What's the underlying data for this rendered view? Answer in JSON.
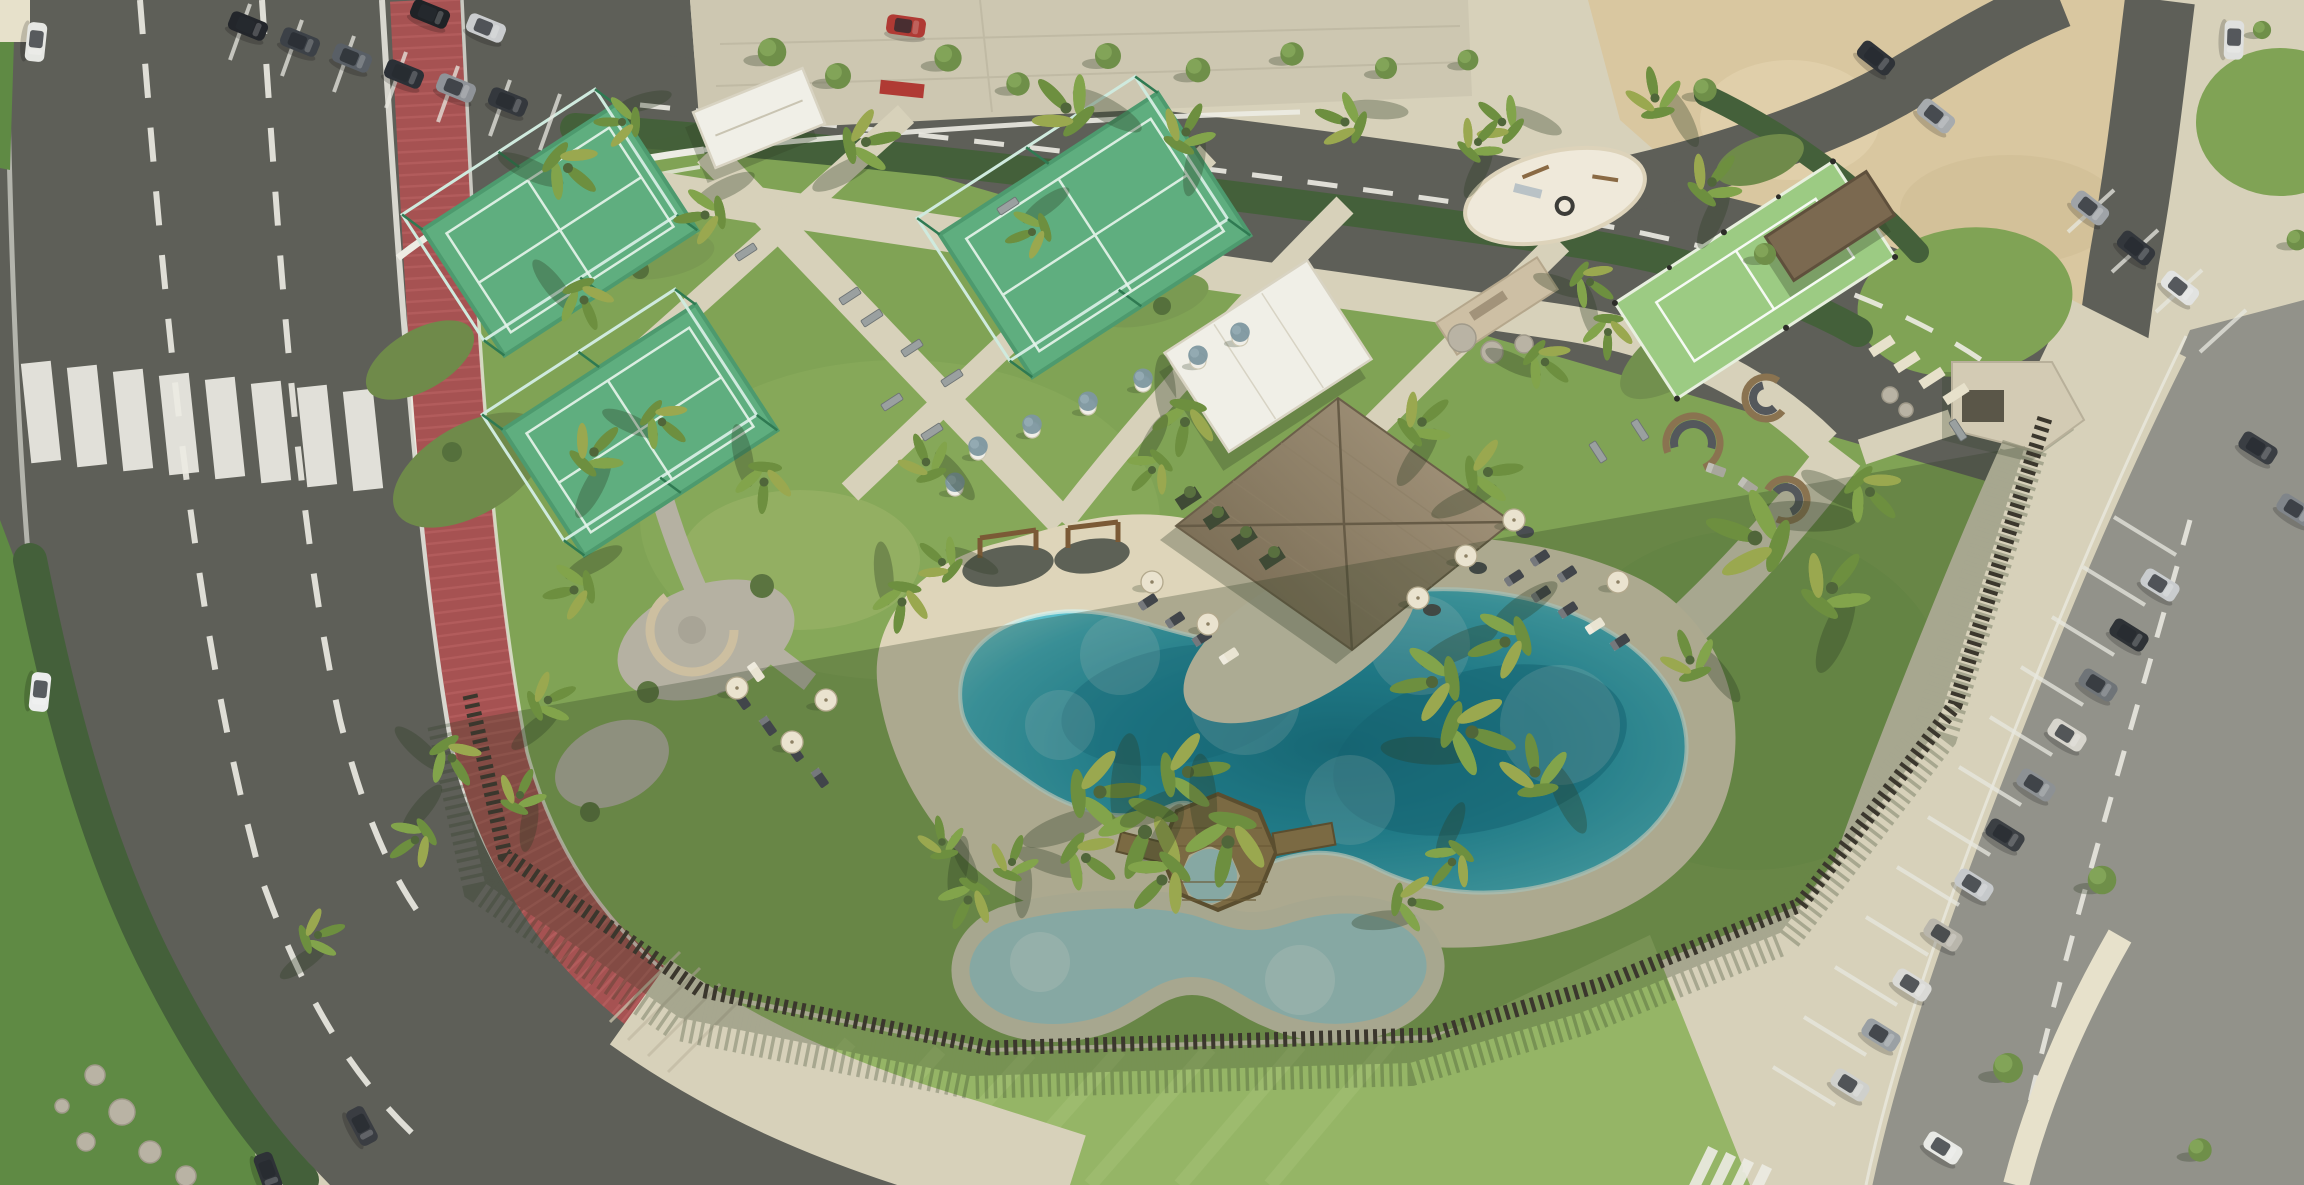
{
  "meta": {
    "title": "aerial-render-resort-amenity-park",
    "description": "Photorealistic aerial rendering of a resort amenity park with lagoon pool, padel courts, clubhouse, parking and roads. No visible text in image."
  },
  "palette": {
    "asphalt": "#5e5f58",
    "asphaltLight": "#6c6d65",
    "parking": "#92928a",
    "pavement": "#d7d1ba",
    "pavementLight": "#e7e1cb",
    "plaza": "#cdc7b1",
    "sandLot": "#d9c7a0",
    "sand": "#ded5ba",
    "lawn": "#80a355",
    "lawnLight": "#95b566",
    "lawnDark": "#5f8a44",
    "hedge": "#44603a",
    "bikePath": "#a65252",
    "bikePathLight": "#bb6565",
    "white": "#edece4",
    "court": "#5fae7f",
    "courtLight": "#79c295",
    "courtLine": "#e8f5ec",
    "courtFrame": "#2f7a52",
    "glass": "#cfeade",
    "sport": "#9ccb83",
    "waterLight": "#63c4cf",
    "water": "#2ba4bd",
    "waterDeep": "#0d7390",
    "kidsWater": "#a9d3d6",
    "wood": "#9a7c50",
    "woodDark": "#6e5634",
    "thatch": "#a2937a",
    "thatchDark": "#7b6e56",
    "whiteBld": "#f0efe7",
    "fence": "#3b372d",
    "gravel": "#b5b1a2",
    "stone": "#cdbfa4",
    "rock": "#b9b3a4",
    "shed": "#7b6950",
    "shadow": "#2d3c23",
    "umbrella": "#eae3cf",
    "olive": "#7d97a0"
  },
  "scene": {
    "palms": [
      [
        568,
        168,
        1.0
      ],
      [
        584,
        300,
        0.9
      ],
      [
        594,
        452,
        0.95
      ],
      [
        574,
        590,
        0.9
      ],
      [
        548,
        700,
        0.85
      ],
      [
        520,
        795,
        0.8
      ],
      [
        452,
        758,
        0.9
      ],
      [
        415,
        840,
        0.85
      ],
      [
        318,
        935,
        0.8
      ],
      [
        622,
        122,
        0.8
      ],
      [
        705,
        215,
        0.9
      ],
      [
        866,
        142,
        1.0
      ],
      [
        1066,
        108,
        1.1
      ],
      [
        1186,
        132,
        0.9
      ],
      [
        1345,
        122,
        0.9
      ],
      [
        1502,
        122,
        0.85
      ],
      [
        1655,
        98,
        0.9
      ],
      [
        1712,
        182,
        0.95
      ],
      [
        662,
        422,
        0.85
      ],
      [
        764,
        482,
        0.9
      ],
      [
        926,
        462,
        0.85
      ],
      [
        1032,
        232,
        0.8
      ],
      [
        1185,
        422,
        1.0
      ],
      [
        1152,
        470,
        0.8
      ],
      [
        1422,
        422,
        0.95
      ],
      [
        1488,
        472,
        1.0
      ],
      [
        1545,
        362,
        0.85
      ],
      [
        1608,
        332,
        0.8
      ],
      [
        902,
        602,
        0.9
      ],
      [
        942,
        562,
        0.8
      ],
      [
        1100,
        792,
        1.3
      ],
      [
        1145,
        832,
        1.4
      ],
      [
        1188,
        772,
        1.2
      ],
      [
        1228,
        842,
        1.3
      ],
      [
        1162,
        880,
        1.1
      ],
      [
        1086,
        858,
        1.0
      ],
      [
        1432,
        682,
        1.2
      ],
      [
        1472,
        732,
        1.3
      ],
      [
        1505,
        642,
        1.1
      ],
      [
        1535,
        772,
        1.1
      ],
      [
        1755,
        538,
        1.45
      ],
      [
        1832,
        588,
        1.2
      ],
      [
        1870,
        492,
        1.0
      ],
      [
        1690,
        660,
        0.9
      ],
      [
        968,
        900,
        0.9
      ],
      [
        1012,
        862,
        0.8
      ],
      [
        942,
        842,
        0.75
      ],
      [
        1412,
        902,
        0.9
      ],
      [
        1452,
        862,
        0.85
      ],
      [
        1478,
        142,
        0.8
      ],
      [
        1590,
        282,
        0.8
      ]
    ],
    "trees": [
      [
        772,
        52,
        1.1
      ],
      [
        838,
        76,
        1.0
      ],
      [
        948,
        58,
        1.05
      ],
      [
        1018,
        84,
        0.9
      ],
      [
        1108,
        56,
        1.0
      ],
      [
        1198,
        70,
        0.95
      ],
      [
        1292,
        54,
        0.9
      ],
      [
        1386,
        68,
        0.85
      ],
      [
        1705,
        90,
        0.9
      ],
      [
        1765,
        254,
        0.85
      ],
      [
        2297,
        240,
        0.8
      ],
      [
        2102,
        880,
        1.1
      ],
      [
        2008,
        1068,
        1.15
      ],
      [
        2200,
        1150,
        0.9
      ],
      [
        1468,
        60,
        0.8
      ],
      [
        2262,
        30,
        0.7
      ]
    ],
    "cars": [
      [
        36,
        42,
        96,
        "#e6e7e3"
      ],
      [
        40,
        692,
        96,
        "#eceded"
      ],
      [
        362,
        1126,
        62,
        "#3a3d42"
      ],
      [
        268,
        1172,
        70,
        "#2e3237"
      ],
      [
        248,
        26,
        22,
        "#23262b"
      ],
      [
        300,
        42,
        22,
        "#3c4147"
      ],
      [
        352,
        58,
        22,
        "#595f66"
      ],
      [
        404,
        74,
        22,
        "#2b3036"
      ],
      [
        456,
        88,
        22,
        "#8f9398"
      ],
      [
        508,
        102,
        22,
        "#34383d"
      ],
      [
        430,
        14,
        22,
        "#1f2226"
      ],
      [
        486,
        28,
        22,
        "#caccce"
      ],
      [
        906,
        26,
        8,
        "#b03a34"
      ],
      [
        2090,
        208,
        38,
        "#9fa3a7"
      ],
      [
        2136,
        248,
        38,
        "#33373c"
      ],
      [
        2180,
        288,
        38,
        "#e2e3e1"
      ],
      [
        1876,
        58,
        38,
        "#2f3338"
      ],
      [
        1936,
        116,
        38,
        "#a7abae"
      ],
      [
        2234,
        40,
        92,
        "#dfe0de"
      ],
      [
        2258,
        448,
        32,
        "#3a3e43"
      ],
      [
        2296,
        510,
        32,
        "#80858a"
      ],
      [
        2160,
        585,
        32,
        "#c9ccce"
      ],
      [
        2129,
        635,
        32,
        "#2e3236"
      ],
      [
        2098,
        685,
        32,
        "#6f7478"
      ],
      [
        2067,
        735,
        32,
        "#d7d5cd"
      ],
      [
        2036,
        785,
        32,
        "#8d9194"
      ],
      [
        2005,
        835,
        32,
        "#3c4044"
      ],
      [
        1974,
        885,
        32,
        "#c6c9cb"
      ],
      [
        1943,
        935,
        32,
        "#b9b6ac"
      ],
      [
        1912,
        985,
        32,
        "#dadad6"
      ],
      [
        1881,
        1035,
        32,
        "#9aa0a4"
      ],
      [
        1850,
        1085,
        32,
        "#cfd0cc"
      ],
      [
        1943,
        1148,
        32,
        "#e8e9e5"
      ]
    ],
    "stall_lines": [
      [
        2176,
        555,
        -62,
        -38
      ],
      [
        2145,
        605,
        -62,
        -38
      ],
      [
        2114,
        655,
        -62,
        -38
      ],
      [
        2083,
        705,
        -62,
        -38
      ],
      [
        2052,
        755,
        -62,
        -38
      ],
      [
        2021,
        805,
        -62,
        -38
      ],
      [
        1990,
        855,
        -62,
        -38
      ],
      [
        1959,
        905,
        -62,
        -38
      ],
      [
        1928,
        955,
        -62,
        -38
      ],
      [
        1897,
        1005,
        -62,
        -38
      ],
      [
        1866,
        1055,
        -62,
        -38
      ],
      [
        1835,
        1105,
        -62,
        -38
      ],
      [
        230,
        60,
        20,
        -56
      ],
      [
        282,
        76,
        20,
        -56
      ],
      [
        334,
        92,
        20,
        -56
      ],
      [
        386,
        108,
        20,
        -56
      ],
      [
        438,
        122,
        20,
        -56
      ],
      [
        490,
        136,
        20,
        -56
      ],
      [
        540,
        150,
        20,
        -56
      ],
      [
        2068,
        232,
        46,
        -42
      ],
      [
        2112,
        272,
        46,
        -42
      ],
      [
        2156,
        312,
        46,
        -42
      ],
      [
        2200,
        352,
        46,
        -42
      ]
    ],
    "loungers": [
      [
        742,
        700,
        55,
        "dark"
      ],
      [
        768,
        726,
        55,
        "dark"
      ],
      [
        795,
        752,
        55,
        "dark"
      ],
      [
        820,
        778,
        55,
        "dark"
      ],
      [
        756,
        672,
        55,
        "light"
      ],
      [
        1148,
        602,
        -33,
        "dark"
      ],
      [
        1175,
        620,
        -33,
        "dark"
      ],
      [
        1202,
        638,
        -33,
        "dark"
      ],
      [
        1229,
        656,
        -33,
        "light"
      ],
      [
        1514,
        578,
        -33,
        "dark"
      ],
      [
        1541,
        594,
        -33,
        "dark"
      ],
      [
        1568,
        610,
        -33,
        "dark"
      ],
      [
        1595,
        626,
        -33,
        "light"
      ],
      [
        1540,
        558,
        -33,
        "dark"
      ],
      [
        1567,
        574,
        -33,
        "dark"
      ],
      [
        1620,
        642,
        -33,
        "dark"
      ],
      [
        1716,
        470,
        20,
        "stone"
      ],
      [
        1748,
        486,
        35,
        "stone"
      ]
    ],
    "umbrellas": [
      [
        737,
        688
      ],
      [
        792,
        742
      ],
      [
        826,
        700
      ],
      [
        1152,
        582
      ],
      [
        1208,
        624
      ],
      [
        1618,
        582
      ],
      [
        1466,
        556
      ],
      [
        1514,
        520
      ],
      [
        1418,
        598
      ]
    ],
    "planters": [
      [
        978,
        452
      ],
      [
        1032,
        430
      ],
      [
        1088,
        407
      ],
      [
        1143,
        384
      ],
      [
        1198,
        361
      ],
      [
        955,
        488
      ],
      [
        1240,
        338
      ]
    ],
    "benches": [
      [
        872,
        318,
        -33
      ],
      [
        912,
        348,
        -33
      ],
      [
        952,
        378,
        -33
      ],
      [
        892,
        402,
        -33
      ],
      [
        932,
        432,
        -33
      ],
      [
        850,
        296,
        -33
      ],
      [
        1598,
        452,
        57
      ],
      [
        1640,
        430,
        57
      ],
      [
        1958,
        430,
        57
      ],
      [
        1008,
        206,
        -33
      ],
      [
        746,
        252,
        -33
      ]
    ],
    "pods": [
      [
        1693,
        443,
        27,
        160
      ],
      [
        1766,
        398,
        21,
        40
      ],
      [
        1786,
        500,
        21,
        210
      ]
    ],
    "rocks": [
      [
        1462,
        338,
        14
      ],
      [
        1492,
        352,
        11
      ],
      [
        1524,
        344,
        9
      ],
      [
        95,
        1075,
        10
      ],
      [
        122,
        1112,
        13
      ],
      [
        86,
        1142,
        9
      ],
      [
        150,
        1152,
        11
      ],
      [
        62,
        1106,
        7
      ],
      [
        186,
        1176,
        10
      ],
      [
        1890,
        395,
        8
      ],
      [
        1906,
        410,
        7
      ]
    ],
    "steps": [
      [
        1882,
        346
      ],
      [
        1907,
        362
      ],
      [
        1932,
        378
      ],
      [
        1956,
        394
      ]
    ],
    "counts": {
      "padel_courts": 3,
      "multisport_court": 1,
      "pools": 2,
      "clubhouse": 1
    }
  }
}
